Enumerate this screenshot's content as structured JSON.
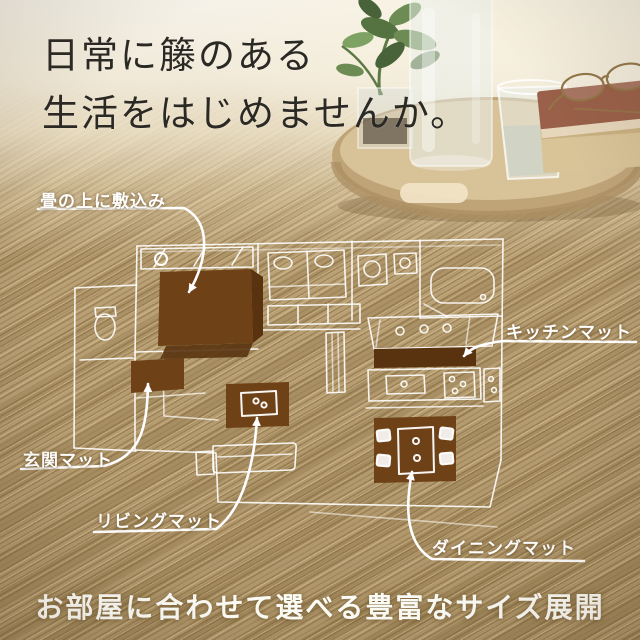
{
  "heading": {
    "line1": "日常に籐のある",
    "line2": "生活をはじめませんか。"
  },
  "floorplan": {
    "labels": {
      "tatami": "畳の上に敷込み",
      "kitchen": "キッチンマット",
      "entrance": "玄関マット",
      "living": "リビングマット",
      "dining": "ダイニングマット"
    }
  },
  "footer": {
    "text": "お部屋に合わせて選べる豊富なサイズ展開"
  },
  "colors": {
    "mat_brown": "#6e4117",
    "mat_brown_dark": "#59330f",
    "line_white": "#ffffff",
    "heading_text": "#2b2924",
    "background_tan": "#b59a6c"
  },
  "scene": {
    "props": [
      "plant",
      "water-carafe",
      "drinking-glass",
      "eyeglasses",
      "books",
      "wooden-tray"
    ]
  }
}
